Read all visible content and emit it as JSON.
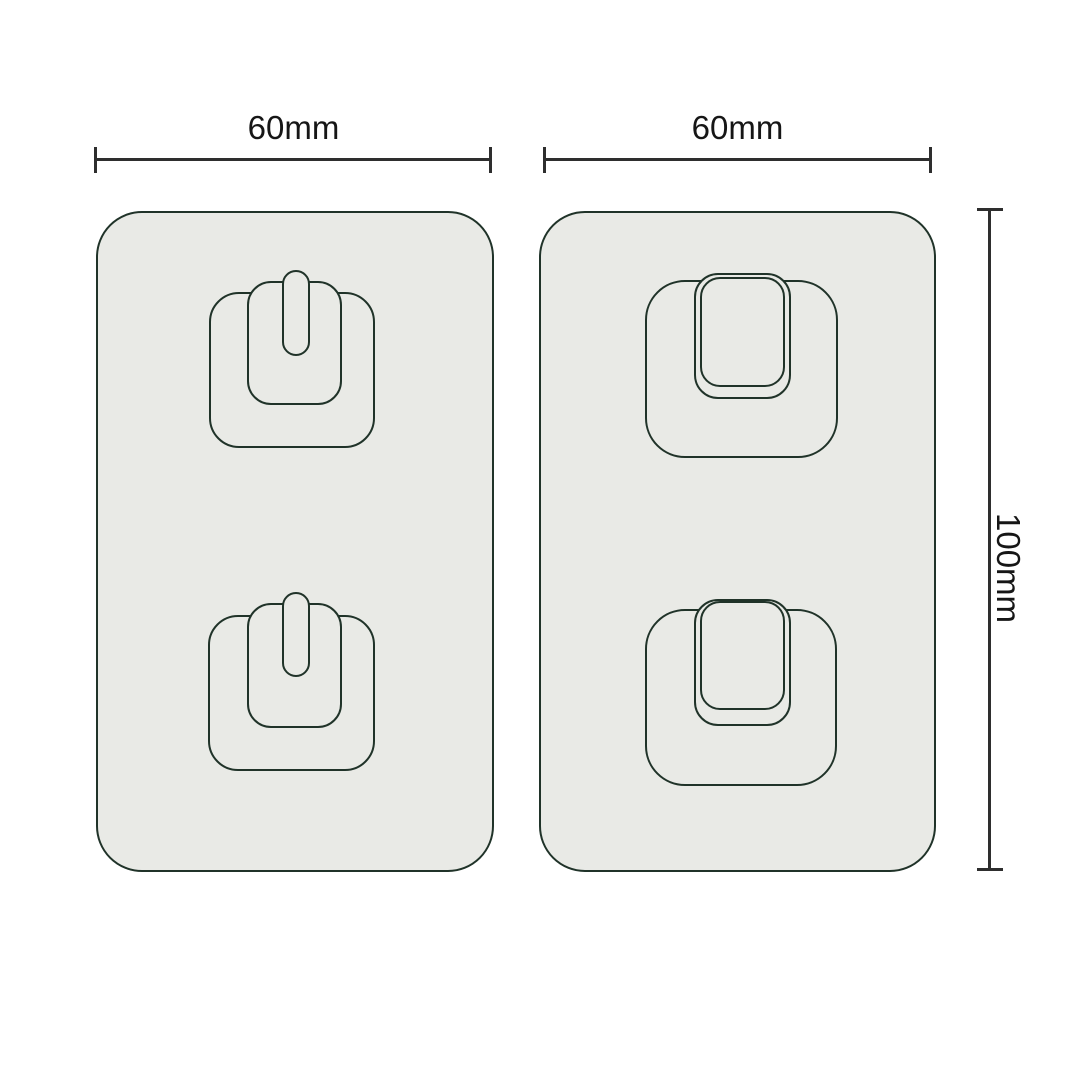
{
  "dimensions": {
    "left_width_label": "60mm",
    "right_width_label": "60mm",
    "height_label": "100mm"
  },
  "colors": {
    "background": "#ffffff",
    "pad_fill": "#e9eae6",
    "pad_outline": "#203329",
    "dimension_line": "#2e2e2e",
    "dimension_text": "#161616"
  },
  "shapes": {
    "left_pad": "adhesive-pad-keyhole-slot-type",
    "right_pad": "adhesive-pad-tab-hook-type",
    "hooks_per_pad": 2
  }
}
